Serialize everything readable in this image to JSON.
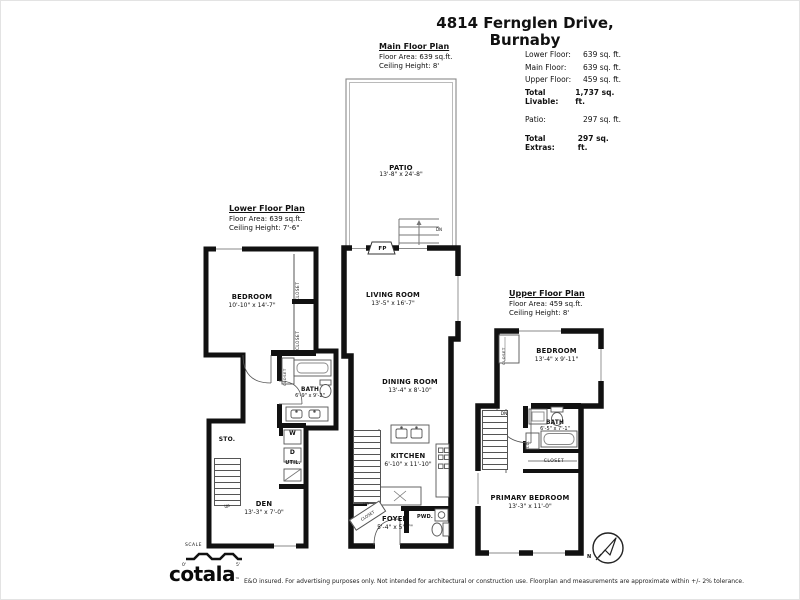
{
  "title": "4814 Fernglen Drive, Burnaby",
  "summary": {
    "lower_label": "Lower Floor:",
    "lower_value": "639 sq. ft.",
    "main_label": "Main Floor:",
    "main_value": "639 sq. ft.",
    "upper_label": "Upper Floor:",
    "upper_value": "459 sq. ft.",
    "total_livable_label": "Total Livable:",
    "total_livable_value": "1,737 sq. ft.",
    "patio_label": "Patio:",
    "patio_value": "297 sq. ft.",
    "total_extras_label": "Total Extras:",
    "total_extras_value": "297 sq. ft."
  },
  "plans": {
    "lower": {
      "name": "Lower Floor Plan",
      "area": "Floor Area: 639 sq.ft.",
      "ceiling": "Ceiling Height: 7'-6\""
    },
    "main": {
      "name": "Main Floor Plan",
      "area": "Floor Area: 639 sq.ft.",
      "ceiling": "Ceiling Height: 8'"
    },
    "upper": {
      "name": "Upper Floor Plan",
      "area": "Floor Area: 459 sq.ft.",
      "ceiling": "Ceiling Height: 8'"
    }
  },
  "rooms": {
    "patio": {
      "name": "PATIO",
      "dims": "13'-8\" x 24'-8\""
    },
    "living_room": {
      "name": "LIVING ROOM",
      "dims": "13'-5\" x 16'-7\""
    },
    "dining_room": {
      "name": "DINING ROOM",
      "dims": "13'-4\" x 8'-10\""
    },
    "kitchen": {
      "name": "KITCHEN",
      "dims": "6'-10\" x 11'-10\""
    },
    "foyer": {
      "name": "FOYER",
      "dims": "5'-4\" x 5'-7\""
    },
    "powder": {
      "name": "PWD."
    },
    "bedroom_lower": {
      "name": "BEDROOM",
      "dims": "10'-10\" x 14'-7\""
    },
    "bath_lower": {
      "name": "BATH",
      "dims": "6'-9\" x 9'-2\""
    },
    "den": {
      "name": "DEN",
      "dims": "13'-3\" x 7'-0\""
    },
    "storage": {
      "name": "STO."
    },
    "utility": {
      "name": "UTIL."
    },
    "washer": "W",
    "dryer": "D",
    "bedroom_upper": {
      "name": "BEDROOM",
      "dims": "13'-4\" x 9'-11\""
    },
    "bath_upper": {
      "name": "BATH",
      "dims": "6'-5\" x 7'-1\""
    },
    "primary_bedroom": {
      "name": "PRIMARY BEDROOM",
      "dims": "13'-3\" x 11'-0\""
    }
  },
  "annotations": {
    "closet": "CLOSET",
    "clo": "CLO.",
    "fireplace": "FP",
    "up": "UP",
    "dn": "DN"
  },
  "scale_bar": {
    "label": "SCALE",
    "start": "0'",
    "end": "5'"
  },
  "compass": {
    "label": "N"
  },
  "footer": {
    "logo": "cotala",
    "tm": "™",
    "disclaimer": "E&O insured. For advertising purposes only. Not intended for architectural or construction use. Floorplan and measurements are approximate within +/- 2% tolerance."
  },
  "colors": {
    "wall": "#111111",
    "thin_line": "#555555"
  }
}
